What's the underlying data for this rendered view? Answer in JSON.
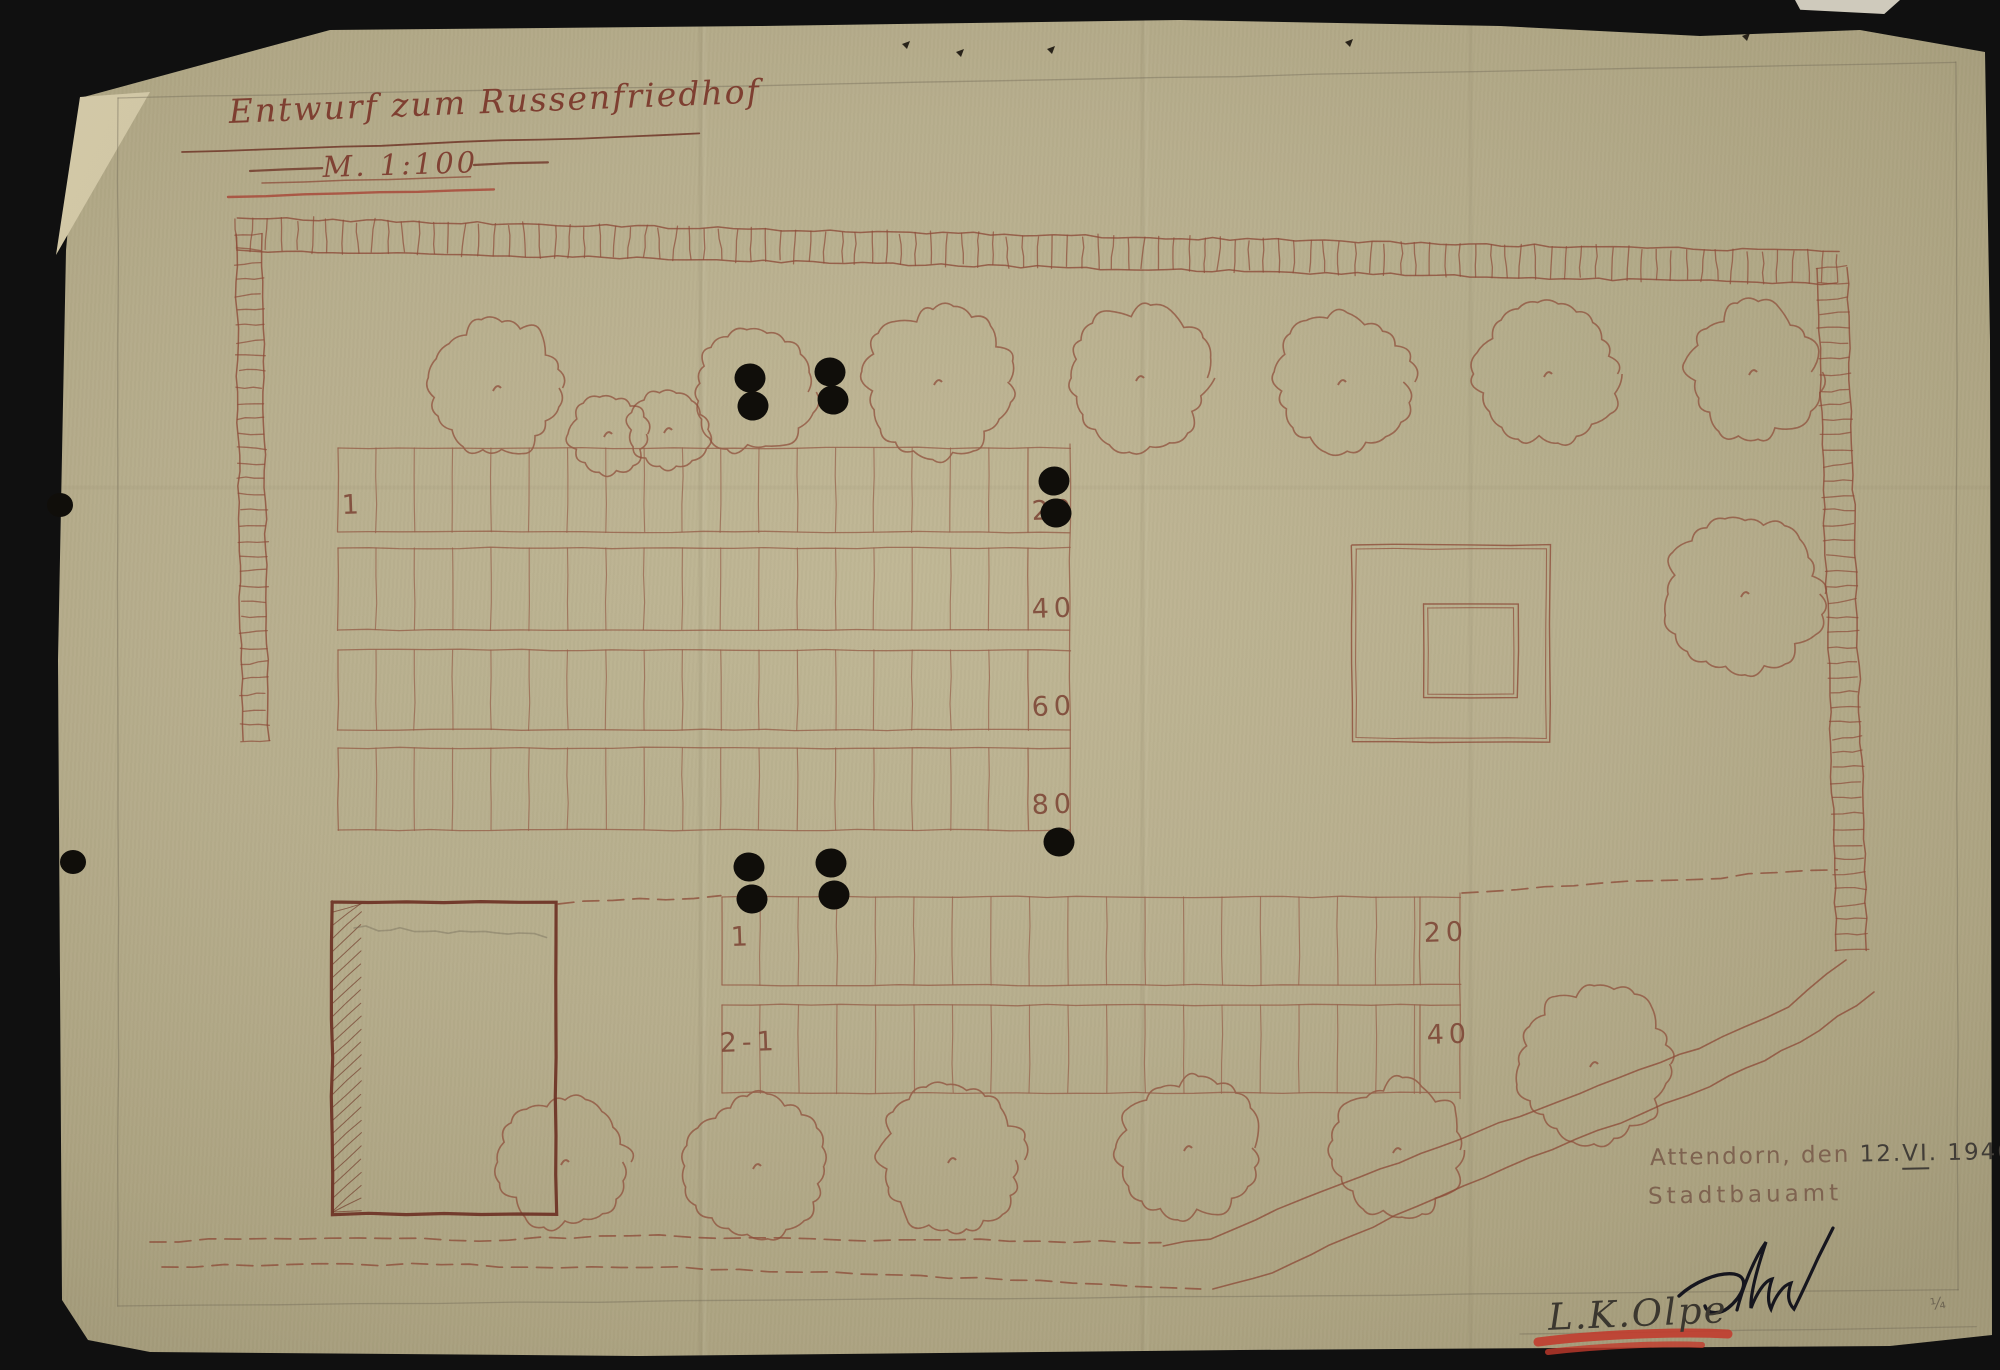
{
  "document": {
    "title": "Entwurf zum Russenfriedhof",
    "scale_label": "M. 1:100",
    "place_line": {
      "place": "Attendorn, den",
      "day": "12.",
      "month": "VI",
      "dot": ".",
      "year": "1946"
    },
    "office": "Stadtbauamt",
    "file_note": "L.K.Olpe",
    "corner_mark": "¼"
  },
  "plan": {
    "colors": {
      "ink": "#8d4c39",
      "ink_dark": "#6f3527",
      "grid": "#96604a",
      "pencil": "#6f6654",
      "black": "#100e0a",
      "red": "#c23a2c",
      "signature": "#16161e",
      "label": "#7d4636"
    },
    "upper_field": {
      "x": 338,
      "right": 1028,
      "label_x": 1070,
      "bands": [
        [
          448,
          532
        ],
        [
          548,
          630
        ],
        [
          650,
          730
        ],
        [
          748,
          830
        ]
      ],
      "first_slot_x": 376,
      "slot_w": 38.3,
      "labels": [
        {
          "text": "20",
          "x": 1032,
          "y": 520
        },
        {
          "text": "40",
          "x": 1032,
          "y": 618
        },
        {
          "text": "60",
          "x": 1032,
          "y": 716
        },
        {
          "text": "80",
          "x": 1032,
          "y": 814
        }
      ],
      "start_labels": [
        {
          "text": "1",
          "x": 342,
          "y": 514
        }
      ]
    },
    "lower_field": {
      "x": 722,
      "right": 1420,
      "label_x": 1460,
      "bands": [
        [
          897,
          985
        ],
        [
          1005,
          1093
        ]
      ],
      "first_slot_x": 760,
      "slot_w": 38.5,
      "labels": [
        {
          "text": "20",
          "x": 1424,
          "y": 942
        },
        {
          "text": "40",
          "x": 1427,
          "y": 1044
        }
      ],
      "start_labels": [
        {
          "text": "1",
          "x": 731,
          "y": 946
        },
        {
          "text": "2-1",
          "x": 720,
          "y": 1052
        }
      ]
    },
    "memorial": {
      "outer": [
        1352,
        545,
        198,
        197
      ],
      "inner": [
        1424,
        604,
        94,
        94
      ]
    },
    "building": {
      "rect": [
        332,
        902,
        224,
        312
      ]
    },
    "hedges": [
      [
        237,
        234,
        1838,
        268,
        32
      ],
      [
        249,
        234,
        255,
        740,
        26
      ],
      [
        1832,
        268,
        1852,
        950,
        30
      ]
    ],
    "trees": [
      [
        497,
        388,
        66
      ],
      [
        608,
        434,
        38
      ],
      [
        668,
        430,
        40
      ],
      [
        752,
        392,
        60
      ],
      [
        938,
        382,
        72
      ],
      [
        1140,
        378,
        70
      ],
      [
        1342,
        382,
        68
      ],
      [
        1548,
        374,
        70
      ],
      [
        1753,
        372,
        66
      ],
      [
        1745,
        594,
        78
      ],
      [
        565,
        1162,
        64
      ],
      [
        757,
        1166,
        70
      ],
      [
        952,
        1160,
        72
      ],
      [
        1188,
        1148,
        70
      ],
      [
        1397,
        1150,
        68
      ],
      [
        1594,
        1064,
        76
      ]
    ],
    "dots": [
      [
        750,
        378
      ],
      [
        753,
        406
      ],
      [
        830,
        372
      ],
      [
        833,
        400
      ],
      [
        1054,
        481
      ],
      [
        1056,
        513
      ],
      [
        749,
        867
      ],
      [
        752,
        899
      ],
      [
        831,
        863
      ],
      [
        834,
        895
      ],
      [
        1059,
        842
      ]
    ],
    "punch_holes": [
      [
        60,
        505
      ],
      [
        73,
        862
      ]
    ],
    "edge_specks": [
      [
        902,
        44
      ],
      [
        956,
        52
      ],
      [
        1047,
        49
      ],
      [
        1345,
        42
      ],
      [
        1742,
        36
      ]
    ],
    "title_underline": [
      182,
      152,
      700,
      134
    ],
    "scale_dashes": [
      [
        250,
        171,
        322,
        168
      ],
      [
        474,
        165,
        548,
        162
      ]
    ],
    "scale_underlines": [
      [
        262,
        183,
        470,
        177
      ],
      [
        228,
        197,
        494,
        189
      ]
    ],
    "dashed_paths": [
      [
        [
          558,
          904
        ],
        [
          640,
          900
        ],
        [
          722,
          897
        ]
      ],
      [
        [
          1462,
          893
        ],
        [
          1600,
          884
        ],
        [
          1720,
          877
        ],
        [
          1838,
          870
        ]
      ],
      [
        [
          150,
          1242
        ],
        [
          300,
          1238
        ],
        [
          480,
          1240
        ],
        [
          660,
          1236
        ],
        [
          840,
          1240
        ],
        [
          1010,
          1240
        ],
        [
          1160,
          1243
        ]
      ],
      [
        [
          162,
          1267
        ],
        [
          320,
          1264
        ],
        [
          500,
          1266
        ],
        [
          680,
          1268
        ],
        [
          860,
          1274
        ],
        [
          1040,
          1281
        ],
        [
          1200,
          1288
        ]
      ]
    ],
    "wavy_paths": [
      [
        [
          1846,
          960
        ],
        [
          1788,
          1006
        ],
        [
          1700,
          1048
        ],
        [
          1600,
          1086
        ],
        [
          1500,
          1124
        ],
        [
          1400,
          1162
        ],
        [
          1300,
          1200
        ],
        [
          1210,
          1238
        ],
        [
          1162,
          1246
        ]
      ],
      [
        [
          1874,
          992
        ],
        [
          1800,
          1042
        ],
        [
          1710,
          1086
        ],
        [
          1620,
          1122
        ],
        [
          1530,
          1158
        ],
        [
          1440,
          1196
        ],
        [
          1350,
          1236
        ],
        [
          1272,
          1272
        ],
        [
          1214,
          1290
        ]
      ]
    ],
    "pencil_lines": [
      [
        118,
        98,
        118,
        1306
      ],
      [
        118,
        1306,
        1958,
        1290
      ],
      [
        1958,
        1290,
        1956,
        62
      ],
      [
        118,
        98,
        1956,
        62
      ],
      [
        1520,
        1334,
        1976,
        1327
      ]
    ]
  }
}
